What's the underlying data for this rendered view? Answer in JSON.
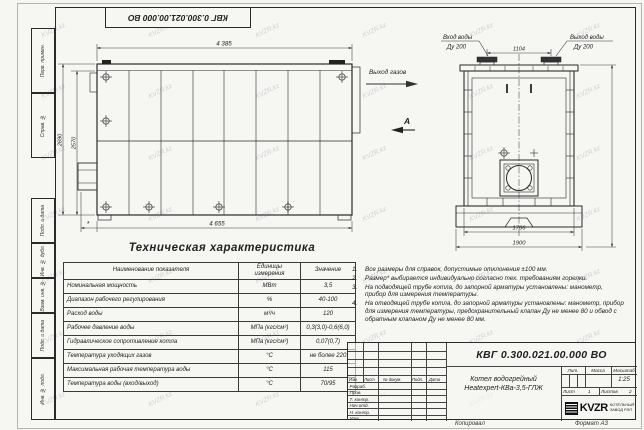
{
  "sheet": {
    "top_stamp": "КВГ 0.300.021.00.000 ВО",
    "margin_labels": [
      "Перв. примен.",
      "Справ. №",
      "Подп. и дата",
      "Инв. № дубл.",
      "Взам. инв. №",
      "Подп. и дата",
      "Инв. № подл."
    ],
    "copy_label": "Копировал",
    "format_label": "Формат А3",
    "watermark": "KVZR.kz"
  },
  "side_view": {
    "dims": {
      "top": "4 385",
      "bottom": "4 655",
      "height_outer": "2690",
      "height_inner": "2570",
      "star": "*"
    },
    "gas_outlet": "Выход газов",
    "view_label": "А"
  },
  "end_view": {
    "inlet": {
      "line1": "Вход воды",
      "line2": "Ду 200"
    },
    "outlet": {
      "line1": "Выход воды",
      "line2": "Ду 200"
    },
    "dims": {
      "nozzle_span": "1104",
      "body_width": "1766",
      "base_width": "1900"
    }
  },
  "spec": {
    "title": "Техническая характеристика",
    "headers": [
      "Наименование показателя",
      "Единицы измерения",
      "Значение"
    ],
    "rows": [
      [
        "Номинальная мощность",
        "МВт",
        "3,5"
      ],
      [
        "Диапазон рабочего регулирования",
        "%",
        "40-100"
      ],
      [
        "Расход воды",
        "м³/ч",
        "120"
      ],
      [
        "Рабочее давление воды",
        "МПа (кгс/см²)",
        "0,3(3,0)-0,6(6,0)"
      ],
      [
        "Гидравлическое сопротивление котла",
        "МПа (кгс/см²)",
        "0,07(0,7)"
      ],
      [
        "Температура уходящих газов",
        "°С",
        "не более 220"
      ],
      [
        "Максимальная рабочая температура воды",
        "°С",
        "115"
      ],
      [
        "Температура воды (вход/выход)",
        "°С",
        "70/95"
      ]
    ]
  },
  "notes": [
    "Все размеры для справок, допустимые отклонения ±100 мм.",
    "Размер* выбирается индивидуально согласно тех. требованиям горелки.",
    "На подводящей трубе котла, до запорной арматуры установлены: манометр, прибор для измерения температуры.",
    "На отводящей трубе котла, до запорной арматуры установлены: манометр, прибор для измерения температуры, предохранительный клапан Ду не менее 80 и обвод с обратным клапаном Ду не менее 80 мм."
  ],
  "title_block": {
    "doc_number": "КВГ 0.300.021.00.000 ВО",
    "product_line1": "Котел водогрейный",
    "product_line2": "Heatexpert-КВа-3,5-ГЛЖ",
    "change_cols": [
      "Изм",
      "Лист",
      "№ докум.",
      "Подп.",
      "Дата"
    ],
    "signature_rows": [
      "Разраб.",
      "Пров.",
      "Т. контр.",
      "Нач.отд.",
      "Н. контр.",
      "Утв."
    ],
    "lit": "Лит.",
    "mass": "Масса",
    "scale": "Масштаб",
    "scale_value": "1:25",
    "sheet": "Лист",
    "sheet_value": "1",
    "sheets": "Листов",
    "sheets_value": "2",
    "logo": {
      "name": "KVZR",
      "sub1": "КОТЕЛЬНЫЙ",
      "sub2": "ЗАВОД РЭП"
    }
  }
}
